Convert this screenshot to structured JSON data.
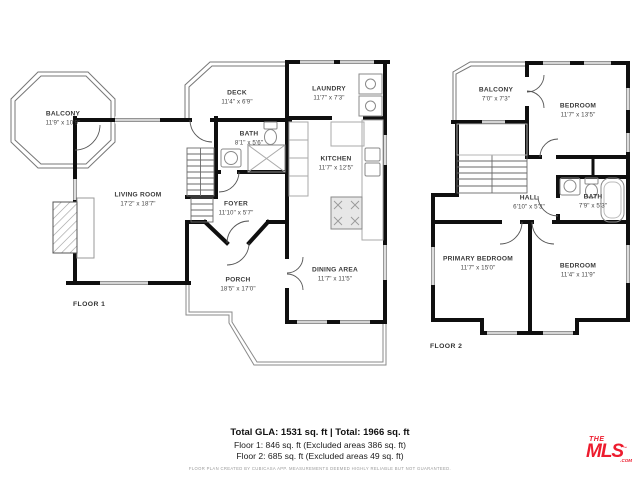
{
  "floor1": {
    "label": "FLOOR 1",
    "rooms": {
      "balcony": {
        "name": "BALCONY",
        "dims": "11'9\" x 10'9\""
      },
      "deck": {
        "name": "DECK",
        "dims": "11'4\" x 6'9\""
      },
      "laundry": {
        "name": "LAUNDRY",
        "dims": "11'7\" x 7'3\""
      },
      "bath": {
        "name": "BATH",
        "dims": "8'1\" x 5'6\""
      },
      "kitchen": {
        "name": "KITCHEN",
        "dims": "11'7\" x 12'5\""
      },
      "living": {
        "name": "LIVING ROOM",
        "dims": "17'2\" x 18'7\""
      },
      "foyer": {
        "name": "FOYER",
        "dims": "11'10\" x 5'7\""
      },
      "porch": {
        "name": "PORCH",
        "dims": "18'5\" x 17'0\""
      },
      "dining": {
        "name": "DINING AREA",
        "dims": "11'7\" x 11'5\""
      }
    }
  },
  "floor2": {
    "label": "FLOOR 2",
    "rooms": {
      "balcony": {
        "name": "BALCONY",
        "dims": "7'0\" x 7'3\""
      },
      "bedroom_top": {
        "name": "BEDROOM",
        "dims": "11'7\" x 13'5\""
      },
      "hall": {
        "name": "HALL",
        "dims": "6'10\" x 5'3\""
      },
      "bath": {
        "name": "BATH",
        "dims": "7'9\" x 5'3\""
      },
      "primary": {
        "name": "PRIMARY BEDROOM",
        "dims": "11'7\" x 15'0\""
      },
      "bedroom_bot": {
        "name": "BEDROOM",
        "dims": "11'4\" x 11'9\""
      }
    }
  },
  "footer": {
    "total_line": "Total GLA: 1531 sq. ft | Total: 1966 sq. ft",
    "floor1_line": "Floor 1: 846 sq. ft (Excluded areas 386 sq. ft)",
    "floor2_line": "Floor 2: 685 sq. ft (Excluded areas 49 sq. ft)",
    "disclaimer": "FLOOR PLAN CREATED BY CUBICASA APP. MEASUREMENTS DEEMED HIGHLY RELIABLE BUT NOT GUARANTEED."
  },
  "logo": {
    "the": "THE",
    "mls": "MLS",
    "tm": "™",
    "com": ".COM",
    "color": "#ED1C2E"
  },
  "colors": {
    "wall": "#0f0f0f",
    "thin_line": "#8a8a8a",
    "fixture": "#8a8a8a"
  }
}
